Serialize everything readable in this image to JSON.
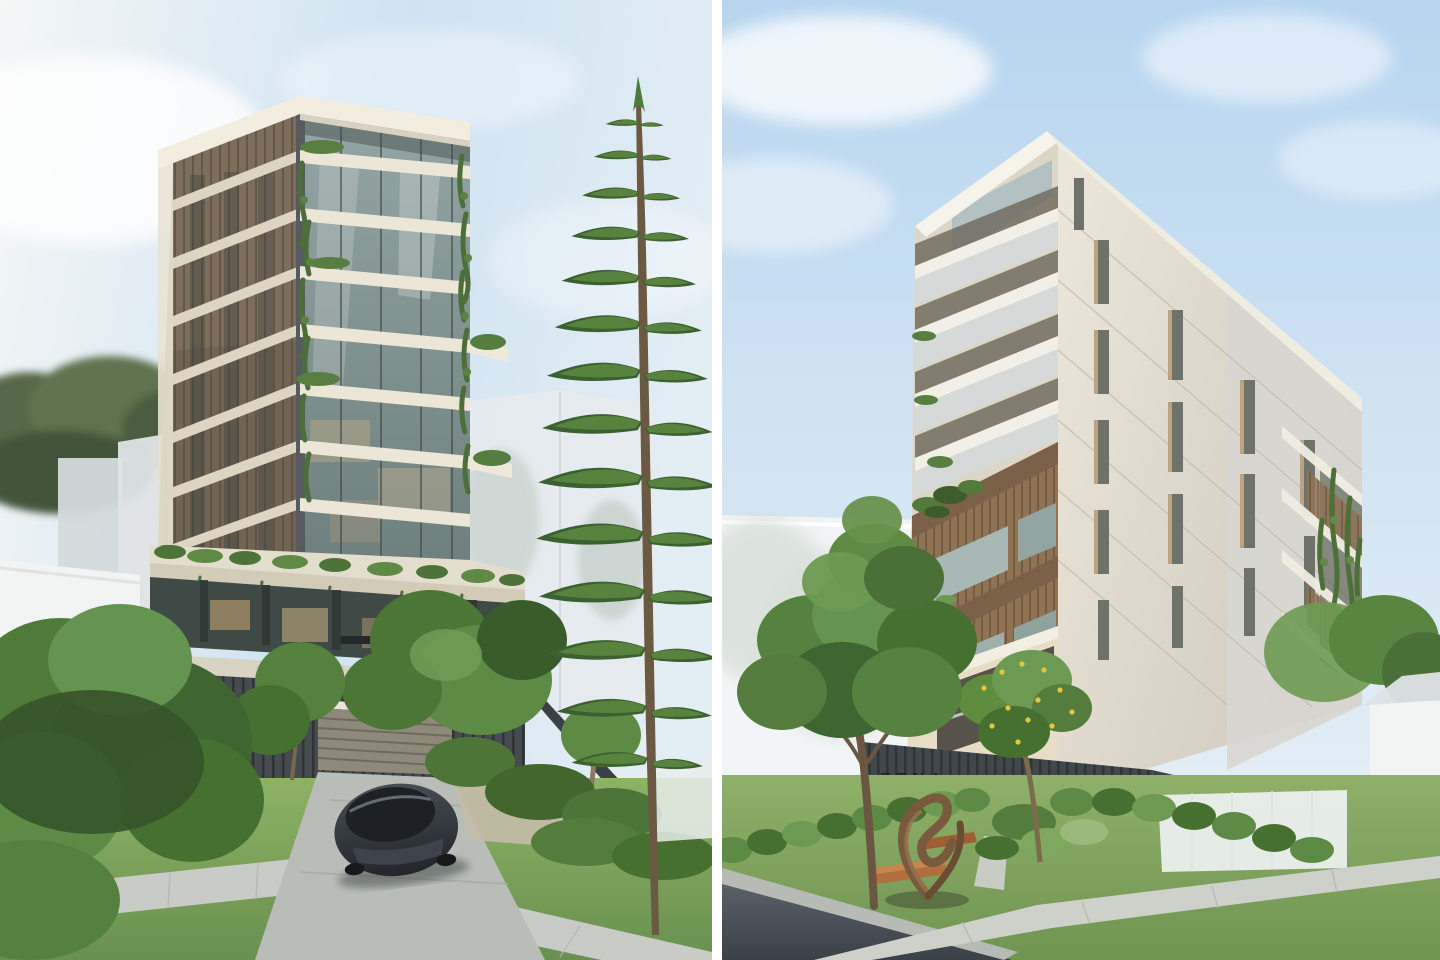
{
  "page": {
    "title": "Residential apartment development — twin exterior renders"
  },
  "views": {
    "left": {
      "alt": "Street view of a ten-storey apartment tower with cream balcony slabs, glass facade, cascading planting, podium terrace, driveway with dark sedan, and a tall Norfolk Island pine in the foreground."
    },
    "right": {
      "alt": "Street corner view of the same building: white corner balconies above timber-clad box balconies, cream brick entry level with dark batten screen, garden with bronze sculpture, lawn, footpath and road."
    }
  },
  "right_view": {
    "signage_text": "ETNA"
  },
  "palette": {
    "divider_white": "#ffffff",
    "sky_blue": "#bcd8ef",
    "sky_haze": "#f2f5f4",
    "building_cream": "#f0ebdd",
    "timber_brown": "#8f7355",
    "glass_teal": "#7c8e8e",
    "foliage_dark": "#3f6630",
    "foliage_light": "#6d9a52",
    "pine_green": "#4c7a38",
    "lawn_green": "#7da65a",
    "concrete_path": "#c9ccc6",
    "asphalt": "#4d555c",
    "fence_charcoal": "#3f4547",
    "sculpture_bronze": "#7a5a3d",
    "car_gray": "#343a40"
  }
}
